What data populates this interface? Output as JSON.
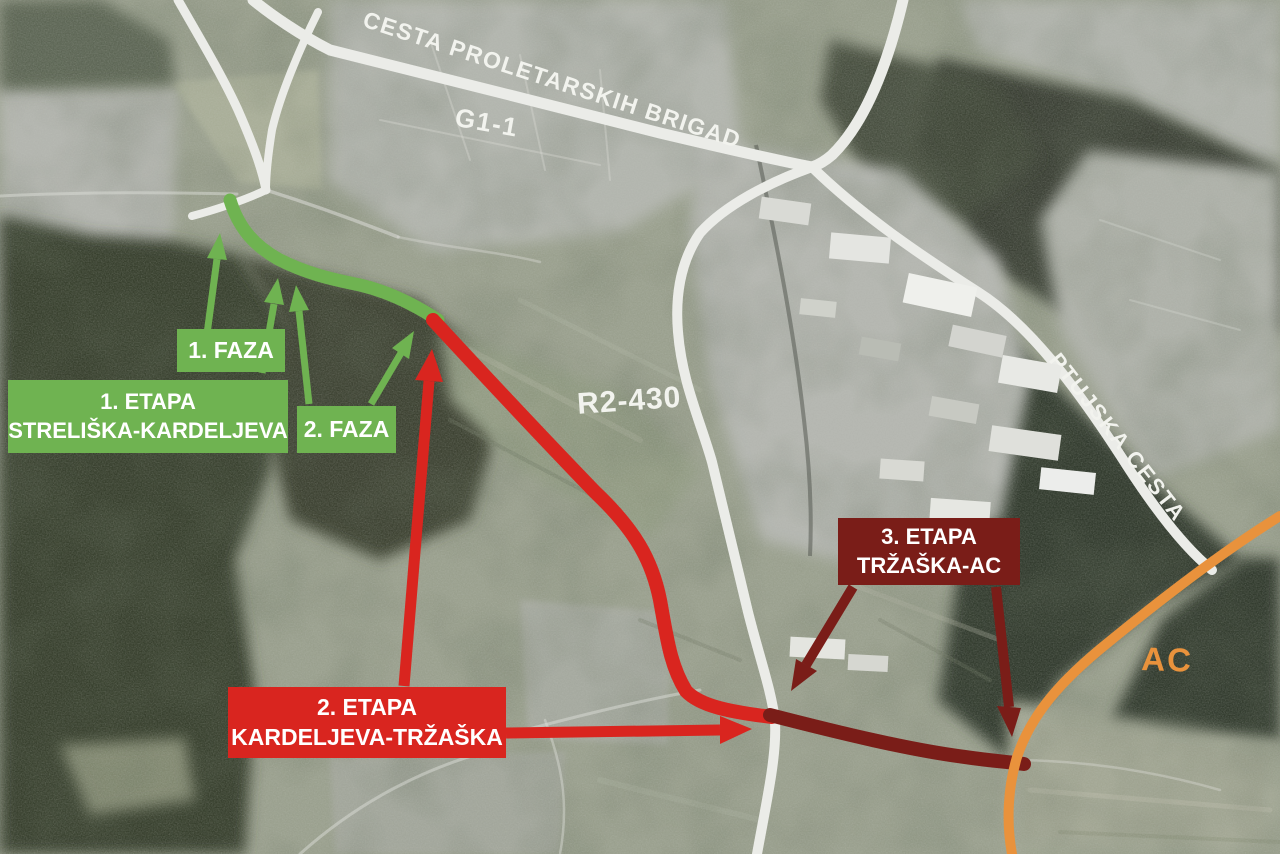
{
  "road_labels": {
    "cesta_proletarskih_brigad": "CESTA PROLETARSKIH BRIGAD",
    "g1_1": "G1-1",
    "r2_430": "R2-430",
    "ptujska_cesta": "PTUJSKA CESTA",
    "ac": "AC"
  },
  "stage_boxes": {
    "faza1": {
      "label": "1. FAZA"
    },
    "etapa1": {
      "line1": "1. ETAPA",
      "line2": "STRELIŠKA-KARDELJEVA"
    },
    "faza2": {
      "label": "2. FAZA"
    },
    "etapa2": {
      "line1": "2. ETAPA",
      "line2": "KARDELJEVA-TRŽAŠKA"
    },
    "etapa3": {
      "line1": "3. ETAPA",
      "line2": "TRŽAŠKA-AC"
    }
  },
  "colors": {
    "phase_green": "#6fb351",
    "phase_red": "#d9251f",
    "phase_darkred": "#7a1d18",
    "highway_orange": "#e9923c",
    "road_label_white": "#f2f3ee"
  }
}
